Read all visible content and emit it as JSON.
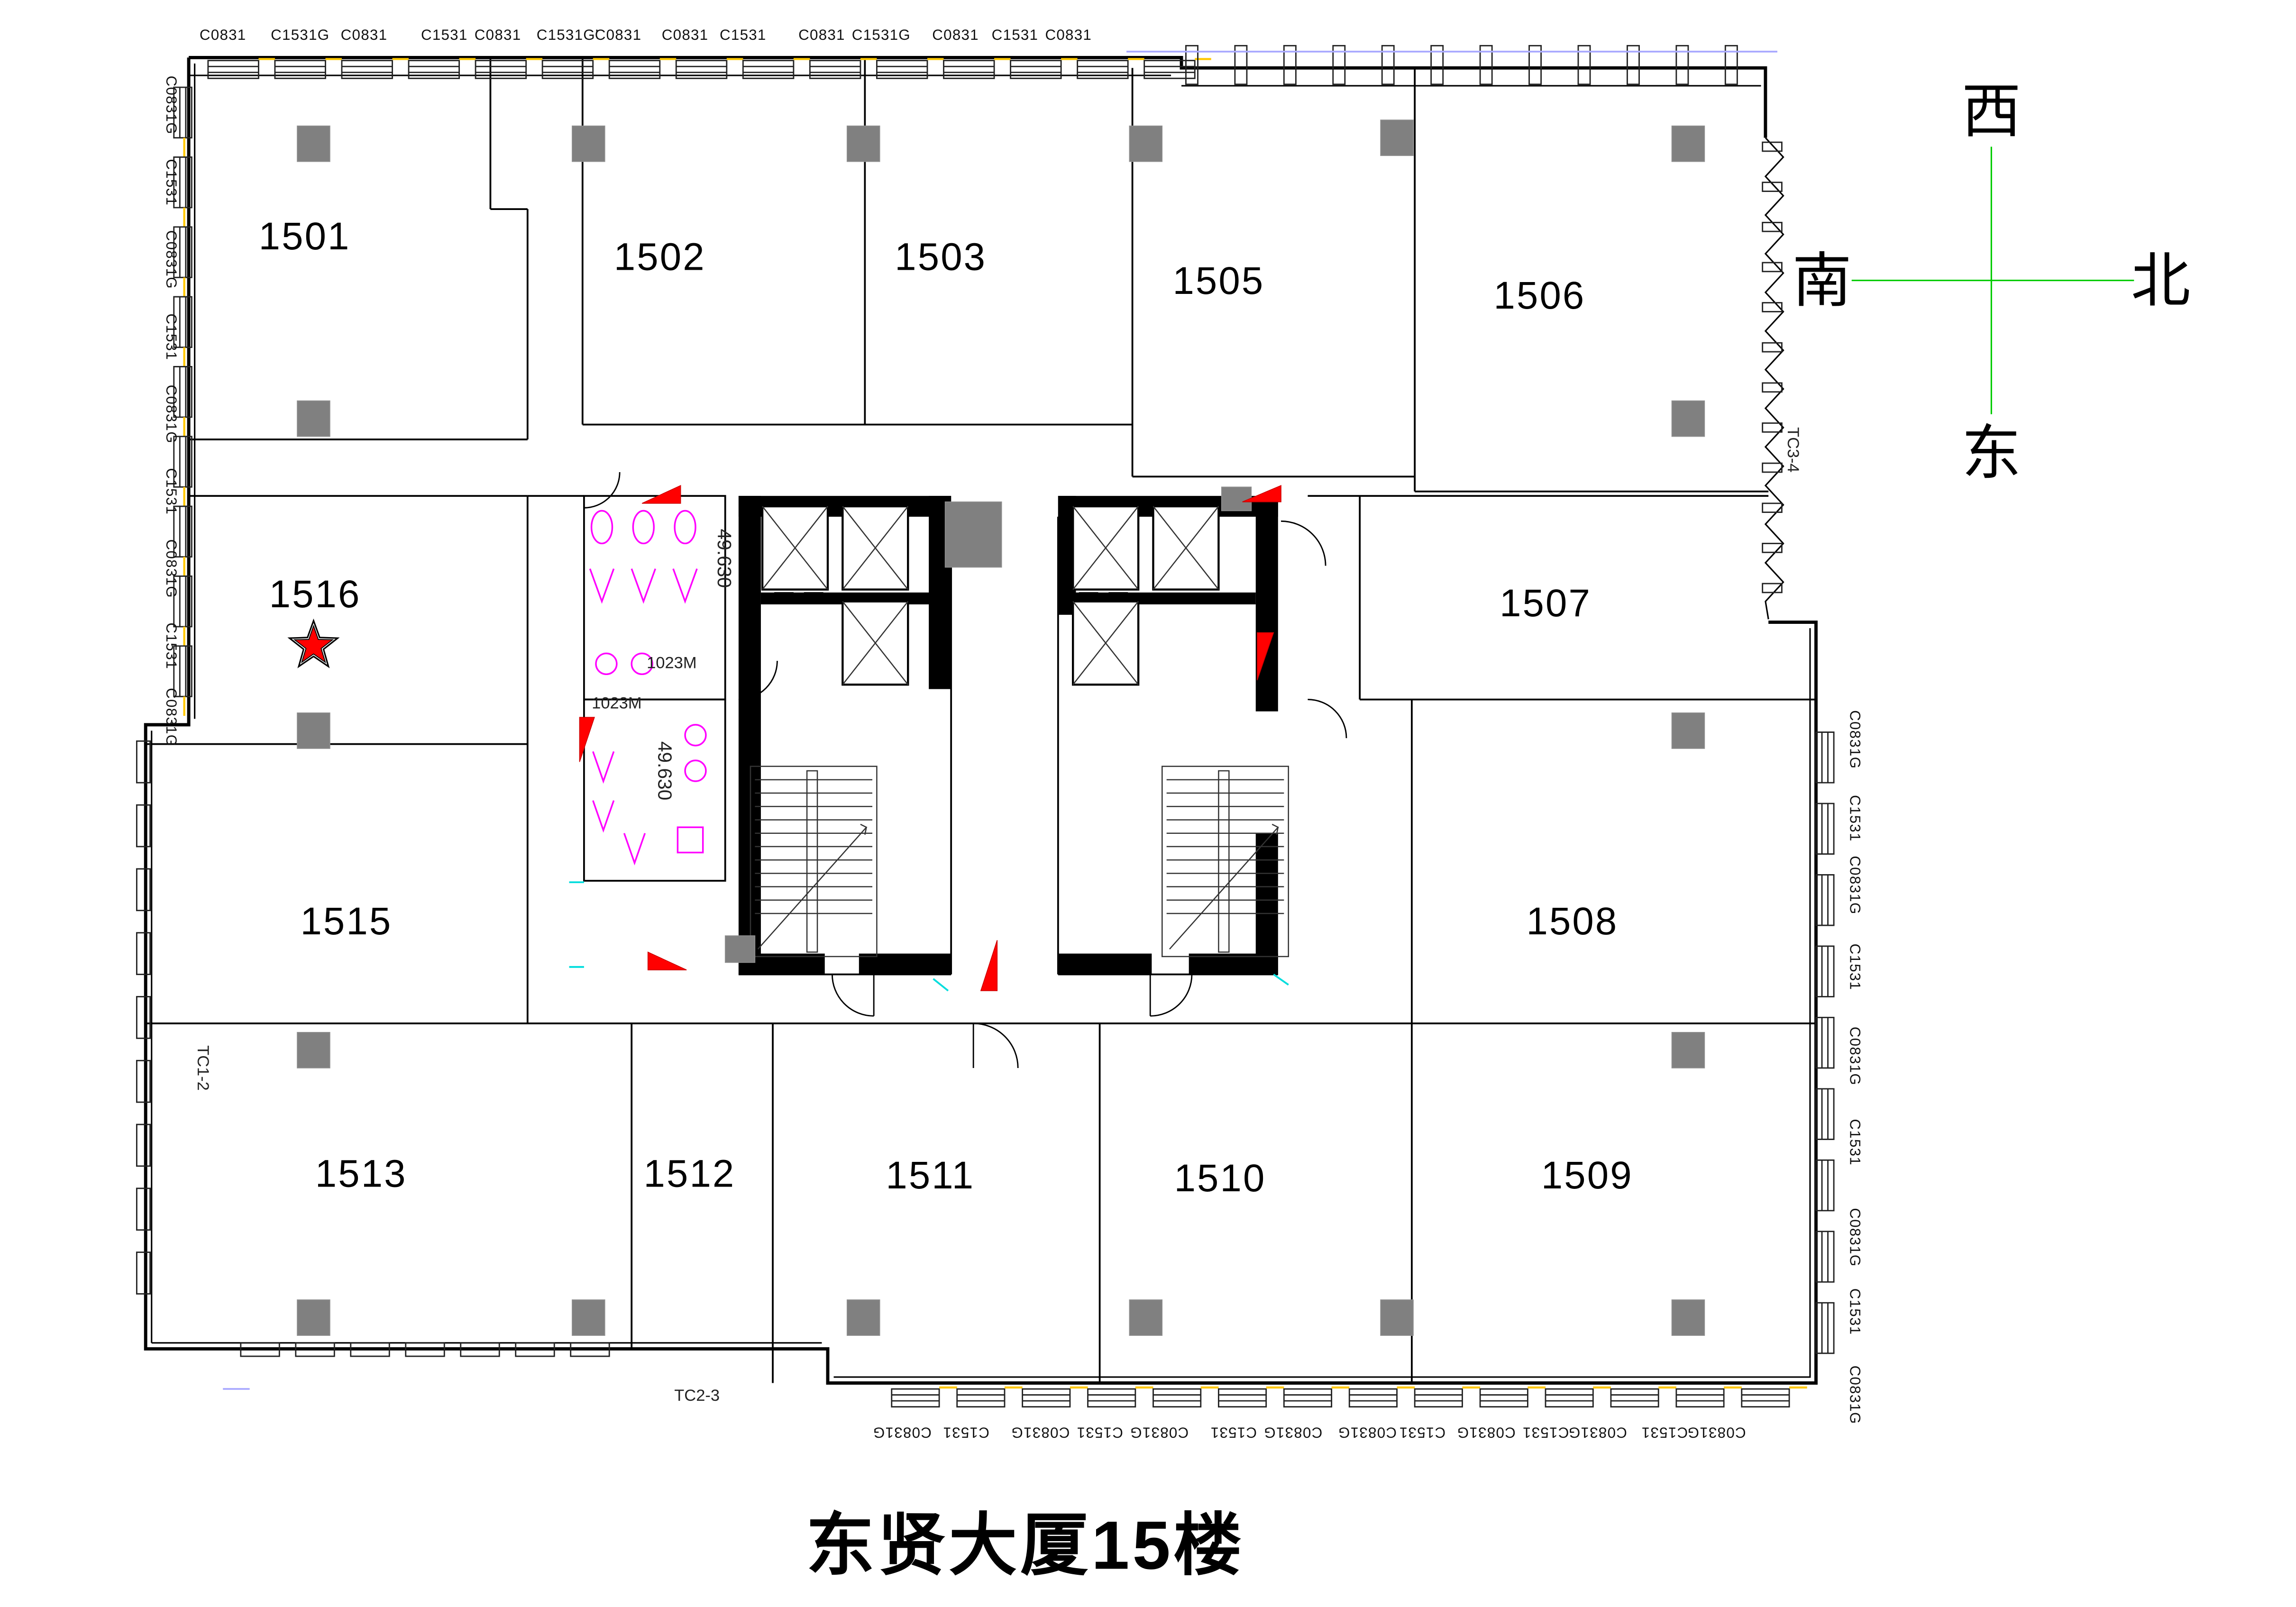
{
  "title": "东贤大厦15楼",
  "compass": {
    "west": "西",
    "south": "南",
    "north": "北",
    "east": "东"
  },
  "rooms": [
    {
      "label": "1501"
    },
    {
      "label": "1502"
    },
    {
      "label": "1503"
    },
    {
      "label": "1505"
    },
    {
      "label": "1506"
    },
    {
      "label": "1507"
    },
    {
      "label": "1508"
    },
    {
      "label": "1509"
    },
    {
      "label": "1510"
    },
    {
      "label": "1511"
    },
    {
      "label": "1512"
    },
    {
      "label": "1513"
    },
    {
      "label": "1515"
    },
    {
      "label": "1516"
    }
  ],
  "starred_room": "1516",
  "window_labels": {
    "top": [
      "C0831",
      "C1531G",
      "C0831",
      "C1531",
      "C0831",
      "C1531G'",
      "C0831",
      "C0831",
      "C1531",
      "C0831",
      "C1531G",
      "C0831",
      "C1531",
      "C0831"
    ],
    "bottom": [
      "C0831G",
      "C1531",
      "C0831G",
      "C1531",
      "C0831G",
      "C1531",
      "C0831G",
      "C0831G",
      "C1531",
      "C0831G",
      "C1531",
      "C0831G",
      "C1531",
      "C0831G"
    ],
    "left": [
      "C0831G",
      "C1531",
      "C0831G",
      "C1531",
      "C0831G",
      "C1531",
      "C0831G",
      "C1531",
      "C0831G"
    ],
    "right": [
      "C0831G",
      "C1531",
      "C0831G",
      "C1531",
      "C0831G",
      "C1531",
      "C0831G",
      "C1531",
      "C0831G"
    ]
  },
  "annotations": {
    "level_a": "49.630",
    "level_b": "49.630",
    "door_a": "1023M",
    "door_b": "1023M",
    "tc_left": "TC1-2",
    "tc_bottom": "TC2-3",
    "tc_right": "TC3-4"
  },
  "colors": {
    "wall": "#000000",
    "column": "#808080",
    "star": "#ff0000",
    "compass_line": "#00cc00",
    "window_accent": "#ffc800",
    "fixture": "#ff00ff",
    "accent_cyan": "#00dddd"
  }
}
